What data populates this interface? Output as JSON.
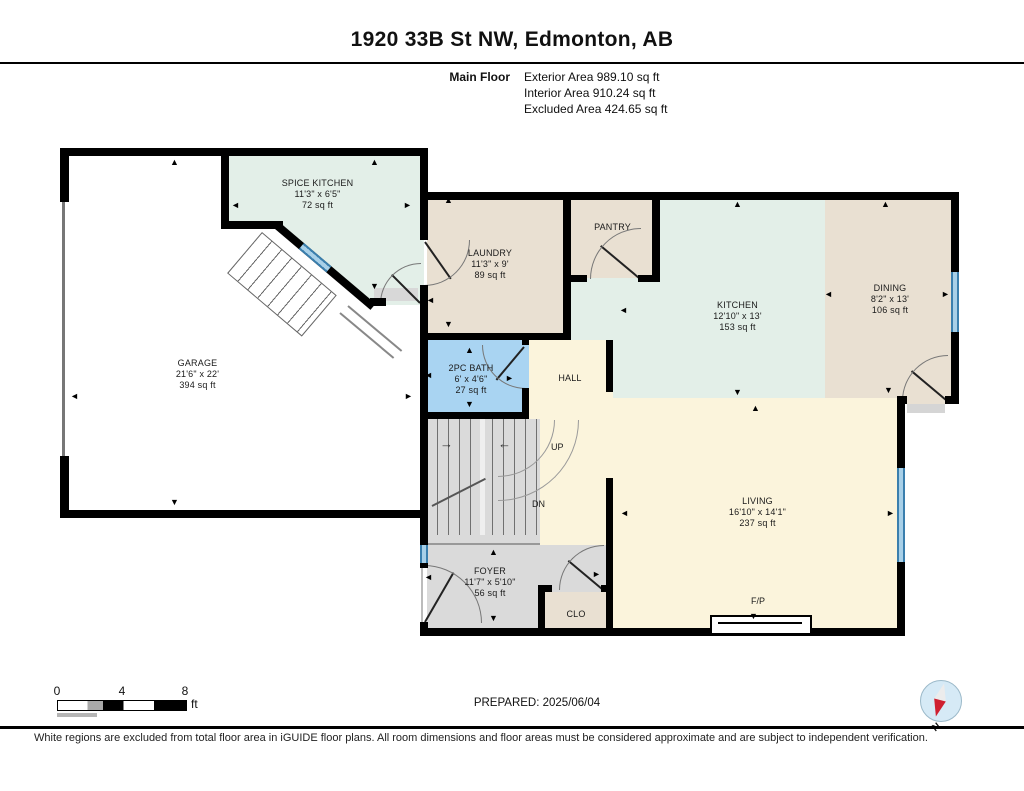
{
  "header": {
    "title": "1920 33B St NW, Edmonton, AB",
    "floor_label": "Main Floor",
    "stats": [
      "Exterior Area 989.10 sq ft",
      "Interior Area 910.24 sq ft",
      "Excluded Area 424.65 sq ft"
    ]
  },
  "rooms": {
    "spice_kitchen": {
      "name": "SPICE KITCHEN",
      "dims": "11'3\" x 6'5\"",
      "area": "72 sq ft"
    },
    "laundry": {
      "name": "LAUNDRY",
      "dims": "11'3\" x 9'",
      "area": "89 sq ft"
    },
    "pantry": {
      "name": "PANTRY"
    },
    "kitchen": {
      "name": "KITCHEN",
      "dims": "12'10\" x 13'",
      "area": "153 sq ft"
    },
    "dining": {
      "name": "DINING",
      "dims": "8'2\" x 13'",
      "area": "106 sq ft"
    },
    "garage": {
      "name": "GARAGE",
      "dims": "21'6\" x 22'",
      "area": "394 sq ft"
    },
    "bath": {
      "name": "2PC BATH",
      "dims": "6' x 4'6\"",
      "area": "27 sq ft"
    },
    "hall": {
      "name": "HALL"
    },
    "living": {
      "name": "LIVING",
      "dims": "16'10\" x 14'1\"",
      "area": "237 sq ft"
    },
    "foyer": {
      "name": "FOYER",
      "dims": "11'7\" x 5'10\"",
      "area": "56 sq ft"
    },
    "closet": {
      "name": "CLO"
    }
  },
  "labels": {
    "up": "UP",
    "dn": "DN",
    "fireplace": "F/P"
  },
  "glyphs": {
    "up": "▲",
    "down": "▼",
    "left": "◄",
    "right": "►",
    "arrow_left": "←",
    "arrow_right": "→"
  },
  "footer": {
    "scale_ticks": [
      "0",
      "4",
      "8"
    ],
    "scale_unit": "ft",
    "prepared": "PREPARED: 2025/06/04",
    "compass": "N",
    "disclaimer": "White regions are excluded from total floor area in iGUIDE floor plans. All room dimensions and floor areas must be considered approximate and are subject to independent verification."
  },
  "colors": {
    "mint": "#e3efe8",
    "tan": "#e9e0d2",
    "bath_blue": "#a9d4f2",
    "cream": "#fbf4dc",
    "gray": "#dadada",
    "window_blue": "#3a7fae",
    "wall": "#000000"
  }
}
